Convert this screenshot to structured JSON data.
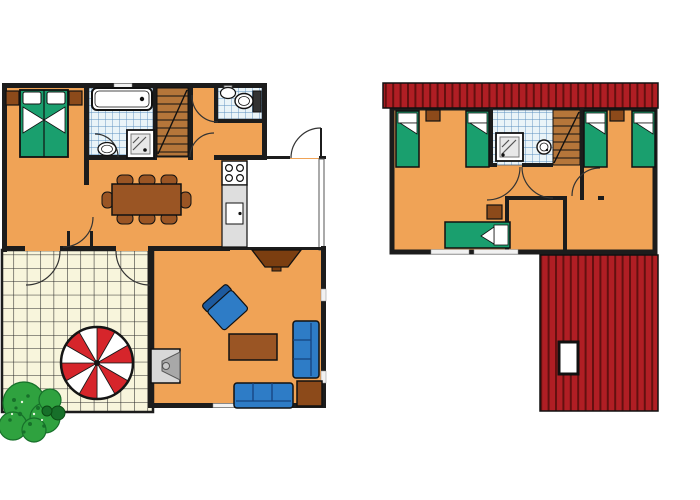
{
  "colors": {
    "floor_orange": "#F0A356",
    "wall_black": "#1C1C1C",
    "bed_green": "#1A9F6E",
    "furniture_brown": "#9A5524",
    "dark_brown": "#7B3E10",
    "side_table_brown": "#8C4A1A",
    "sofa_blue": "#2E7CC6",
    "sofa_blue_dark": "#1D5A9E",
    "tile_bg": "#EAF4F8",
    "tile_line": "#5B8FC0",
    "terrace_bg": "#F8F5DC",
    "terrace_line": "#2A2A2A",
    "roof_red": "#B01E24",
    "roof_stripe": "#63100F",
    "parasol_red": "#D6252B",
    "counter_gray": "#DEDEDE",
    "stairs_tan": "#B5763A",
    "bush_green": "#2FA23F",
    "bush_dark": "#17702A",
    "fireplace_gray": "#D8D8D8",
    "fireplace_dark": "#A8A8A8",
    "window_gap": "#F1F1F1"
  },
  "ground_floor": {
    "label": "ground-floor-plan",
    "rooms": [
      "master-bedroom",
      "bathroom",
      "staircase",
      "wc",
      "hallway",
      "kitchen",
      "dining-area",
      "living-room",
      "entrance-porch",
      "terrace"
    ],
    "furniture": {
      "master_bedroom": [
        "double-bed",
        "nightstand-left",
        "nightstand-right"
      ],
      "bathroom": [
        "bathtub",
        "washbasin",
        "shower"
      ],
      "wc": [
        "washbasin",
        "toilet"
      ],
      "kitchen": [
        "stove-four-burners",
        "counter-with-sink"
      ],
      "dining_area": [
        "dining-table",
        "eight-chairs"
      ],
      "living_room": [
        "tv",
        "armchair",
        "coffee-table",
        "lounge-sofa",
        "two-seat-sofa",
        "side-table",
        "fireplace"
      ],
      "terrace": [
        "parasol",
        "garden-bushes"
      ]
    }
  },
  "upper_floor": {
    "label": "upper-floor-plan",
    "rooms": [
      "bedroom-left",
      "shower-room",
      "staircase",
      "bedroom-right",
      "landing",
      "bedroom-front"
    ],
    "furniture": {
      "bedroom_left": [
        "single-bed",
        "single-bed",
        "nightstand"
      ],
      "shower_room": [
        "shower",
        "washbasin"
      ],
      "bedroom_right": [
        "single-bed",
        "single-bed",
        "nightstand"
      ],
      "bedroom_front": [
        "single-bed",
        "nightstand"
      ]
    },
    "roof": [
      "roof-ridge-strip",
      "roof-slope-with-skylight"
    ]
  },
  "decorations": {
    "parasol": {
      "cx": 97,
      "cy": 363,
      "r": 36,
      "wedge_count": 12,
      "color_a": "parasol_red",
      "color_b": "#FFFFFF"
    }
  }
}
